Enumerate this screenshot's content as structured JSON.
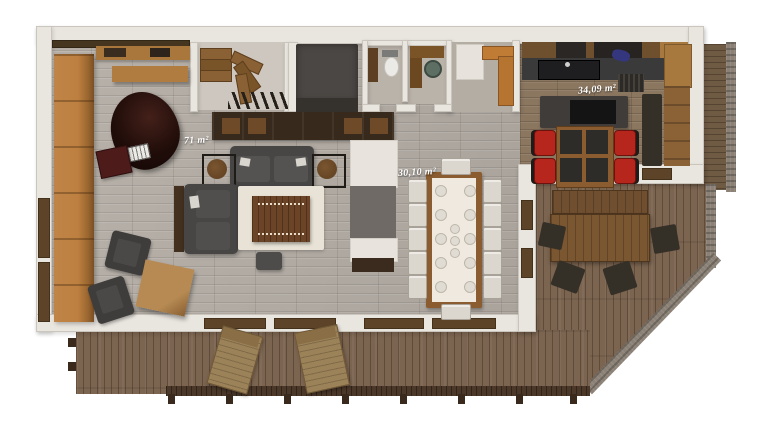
{
  "rooms": [
    {
      "id": "living-room",
      "area_label": "71 m²"
    },
    {
      "id": "dining-area",
      "area_label": "30,10 m²"
    },
    {
      "id": "kitchen",
      "area_label": "34,09 m²"
    }
  ],
  "dining": {
    "seat_count": 12
  },
  "kitchen_bar": {
    "chair_count": 4
  },
  "colors": {
    "floor-gray": "#b3aca4",
    "floor-kitchen": "#8b7660",
    "deck-wood": "#7b6450",
    "wall-white": "#e9e5df",
    "bench-wood": "#c08448",
    "furniture-dark": "#474645",
    "table-wood": "#8a5c30",
    "chair-red": "#b7261d",
    "rug-cream": "#e9e3d7",
    "railing-dark": "#4b3829",
    "stone-gray": "#8b8176"
  }
}
